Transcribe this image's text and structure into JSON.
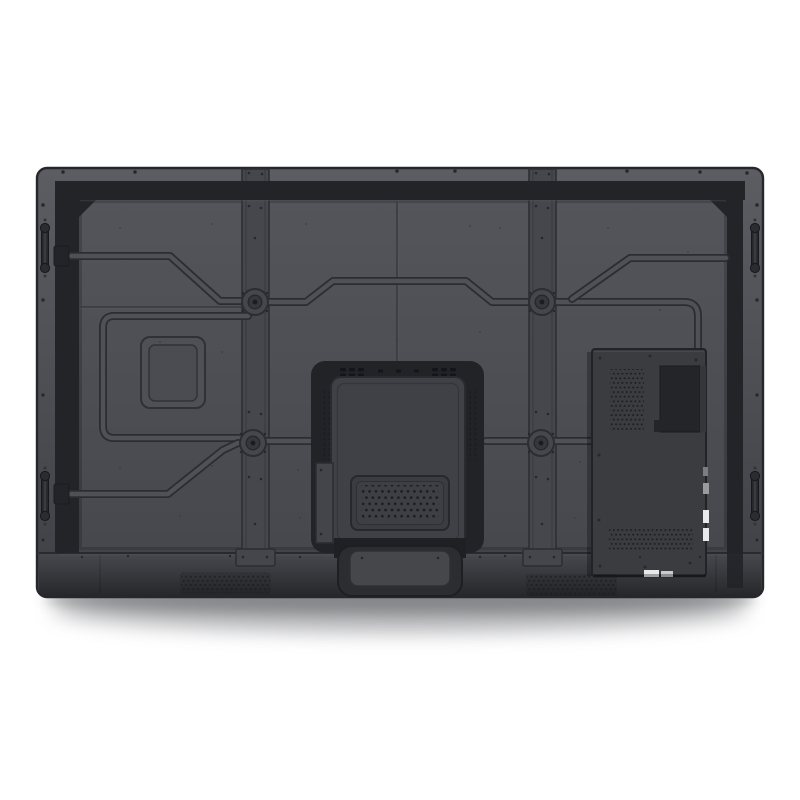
{
  "meta": {
    "subject": "rear-view-product-photo-of-interactive-flat-panel-display",
    "visible_text": "none"
  },
  "colors": {
    "bg": "#ffffff",
    "body_top": "#5c5d62",
    "body_mid": "#4c4d52",
    "body_low": "#3f4045",
    "frame_line": "#26272b",
    "band": "#232428",
    "panel_top": "#53555b",
    "panel_bot": "#46484d",
    "rail": "#46474c",
    "rail_edge": "#2b2d31",
    "ridge_line": "#2b2d31",
    "ridge_fill": "#4f5157",
    "seam": "#393b3f",
    "recess": "#222327",
    "bracket": "#3f4146",
    "bracket_line": "#292b2f",
    "module": "#3a3c40",
    "module_dark": "#242529",
    "hole": "#1c1d20",
    "apron_top": "#48494e",
    "apron_bot": "#2f3034",
    "plate": "#4e5055",
    "tongue_outer": "#2c2d31",
    "tongue_inner": "#45474b",
    "handle": "#26272b",
    "screw": "#24262a",
    "connector": "#e8e9ea",
    "shadow": "#97989b"
  },
  "parts": {
    "housing": "back-housing",
    "rails": [
      "vesa-rail-left",
      "vesa-rail-right"
    ],
    "channels": "cable-routing-channels",
    "mount": "wall-mount-recess-with-bracket",
    "module": "ops-slot-module",
    "speakers": [
      "speaker-grille-left",
      "speaker-grille-right"
    ],
    "handles": [
      "handle-left-top",
      "handle-left-bottom",
      "handle-right-top",
      "handle-right-bottom"
    ],
    "counts": {
      "screw_bosses": 4,
      "handles": 4,
      "speaker_grilles": 2
    }
  }
}
